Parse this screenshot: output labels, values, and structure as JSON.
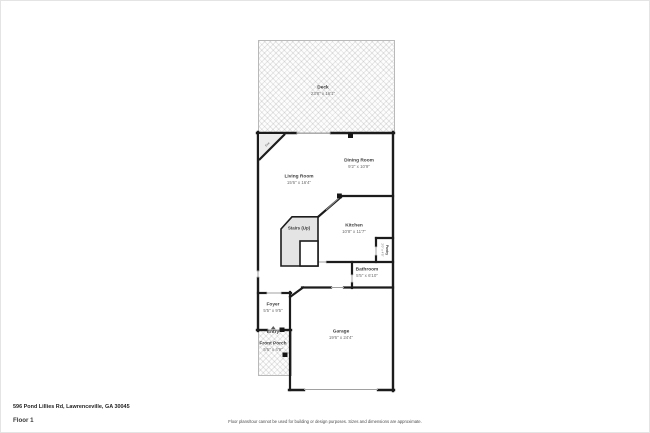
{
  "floorplan": {
    "rooms": {
      "deck": {
        "name": "Deck",
        "dims": "23'8\" x 16'1\""
      },
      "living_room": {
        "name": "Living Room",
        "dims": "15'6\" x 16'4\""
      },
      "dining_room": {
        "name": "Dining Room",
        "dims": "9'2\" x 10'9\""
      },
      "kitchen": {
        "name": "Kitchen",
        "dims": "10'8\" x 11'7\""
      },
      "stairs": {
        "name": "Stairs (Up)"
      },
      "pantry": {
        "name": "Pantry",
        "dims": "2'0\" x 4'5\""
      },
      "bathroom": {
        "name": "Bathroom",
        "dims": "5'5\" x 6'10\""
      },
      "foyer": {
        "name": "Foyer",
        "dims": "5'5\" x 9'5\""
      },
      "entry": {
        "name": "Entry"
      },
      "front_porch": {
        "name": "Front Porch",
        "dims": "5'6\" x 4'9\""
      },
      "garage": {
        "name": "Garage",
        "dims": "19'6\" x 24'4\""
      },
      "fireplace": {
        "name": "Fire"
      }
    },
    "colors": {
      "wall": "#1c1c1c",
      "opening": "#a0a0a0",
      "stairs_fill": "#e4e4e4",
      "hatch_border": "#b9b9b9"
    }
  },
  "footer": {
    "address": "596 Pond Lillies Rd, Lawrenceville, GA 30045",
    "floor_label": "Floor 1",
    "disclaimer": "Floor plans/tour cannot be used for building or design purposes. Sizes and dimensions are approximate."
  }
}
